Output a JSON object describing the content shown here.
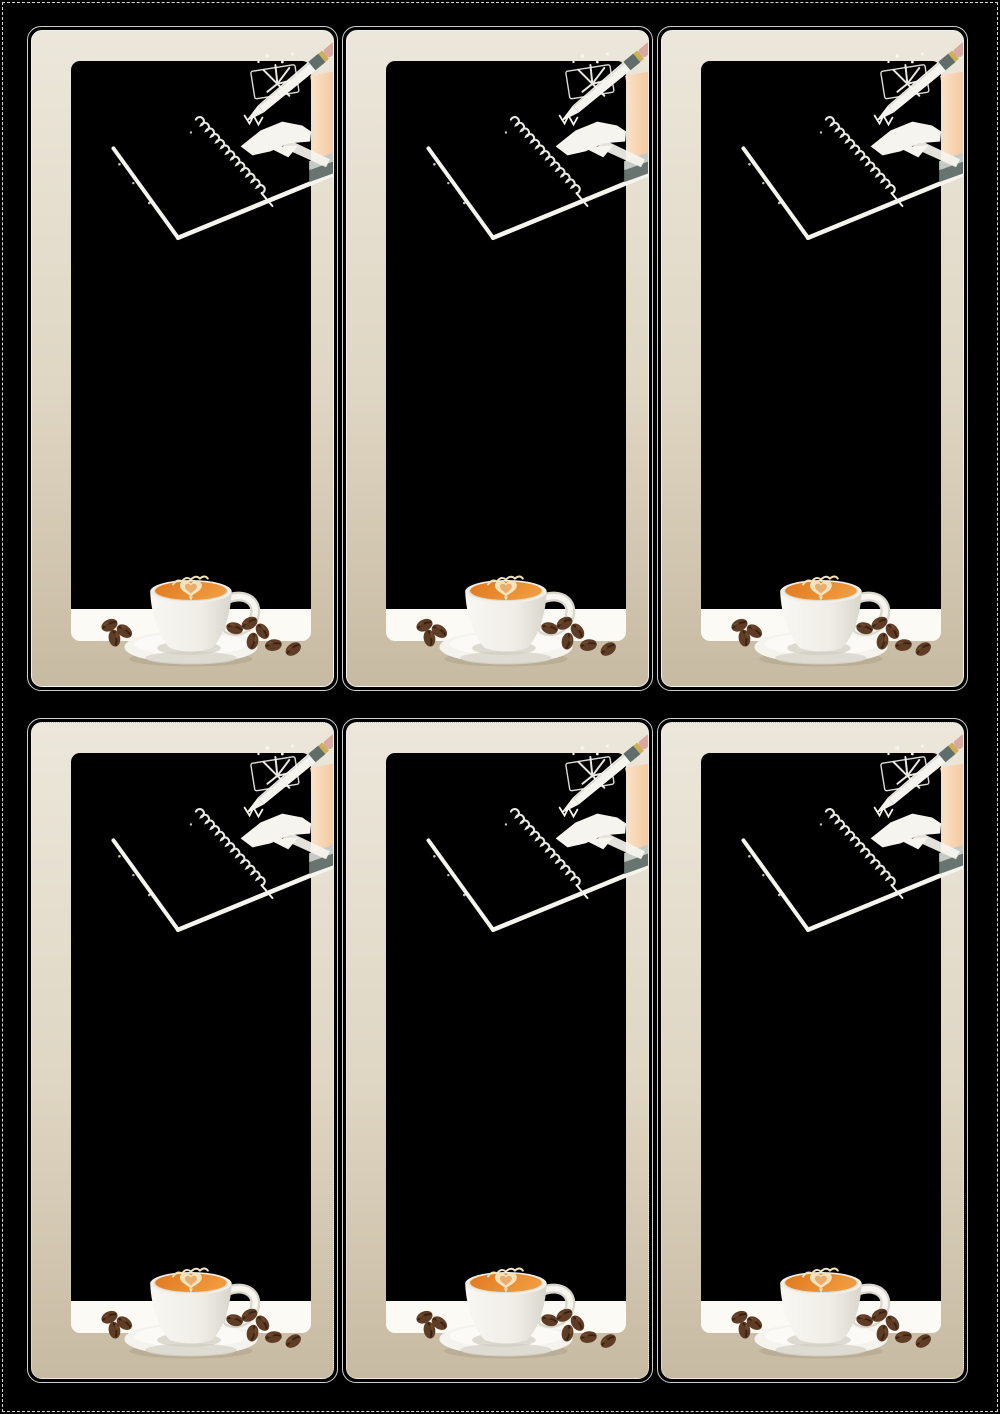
{
  "page": {
    "background": "#000000",
    "cut_guide": "white dashed border around sheet"
  },
  "sheet": {
    "name": "coffee-bookmark-print-sheet",
    "rows": 2,
    "columns": 3,
    "card_count": 6,
    "cards": [
      {
        "id": "bookmark-1",
        "row": 1,
        "col": 1,
        "inner_outline": "solid"
      },
      {
        "id": "bookmark-2",
        "row": 1,
        "col": 2,
        "inner_outline": "solid"
      },
      {
        "id": "bookmark-3",
        "row": 1,
        "col": 3,
        "inner_outline": "solid"
      },
      {
        "id": "bookmark-4",
        "row": 2,
        "col": 1,
        "inner_outline": "dotted"
      },
      {
        "id": "bookmark-5",
        "row": 2,
        "col": 2,
        "inner_outline": "dotted"
      },
      {
        "id": "bookmark-6",
        "row": 2,
        "col": 3,
        "inner_outline": "dotted"
      }
    ]
  },
  "artwork": {
    "style": "white line art on black panel with photographic-style latte cup",
    "elements": [
      "spiral-notebook-sketch",
      "hand-holding-pen",
      "pen-with-pink-eraser",
      "arm-reaching-from-right",
      "coffee-cup-with-latte-heart",
      "saucer",
      "coffee-beans"
    ]
  },
  "colors": {
    "page-bg": "#000000",
    "outline-outer": "#cfcfcf",
    "outline-inner": "#f1f1f1",
    "frame-top": "#ece7db",
    "frame-mid": "#dfd6c3",
    "frame-bottom": "#c7baa2",
    "panel-black": "#000000",
    "strip-white": "#fcfaf5",
    "art-white": "#f6f4ee",
    "skin-light": "#fbe3c8",
    "skin-deep": "#f1bf93",
    "eraser-pink": "#d9a8a0",
    "band-gold": "#cdaf55",
    "band-grey": "#616d6a",
    "cuff-light": "#c6cac4",
    "cuff-teal": "#67746f",
    "coffee-orange": "#e0771e",
    "coffee-light": "#f09a3e",
    "latte-cream": "#f2e3bd",
    "cup-white": "#f8f7f3",
    "cup-shade": "#d9d6cc",
    "saucer-white": "#f4f3ee",
    "bean-brown": "#5e3c26",
    "bean-crease": "#38220f",
    "bean-highlight": "#8a5a38",
    "shadow-tan": "#a79b84"
  }
}
